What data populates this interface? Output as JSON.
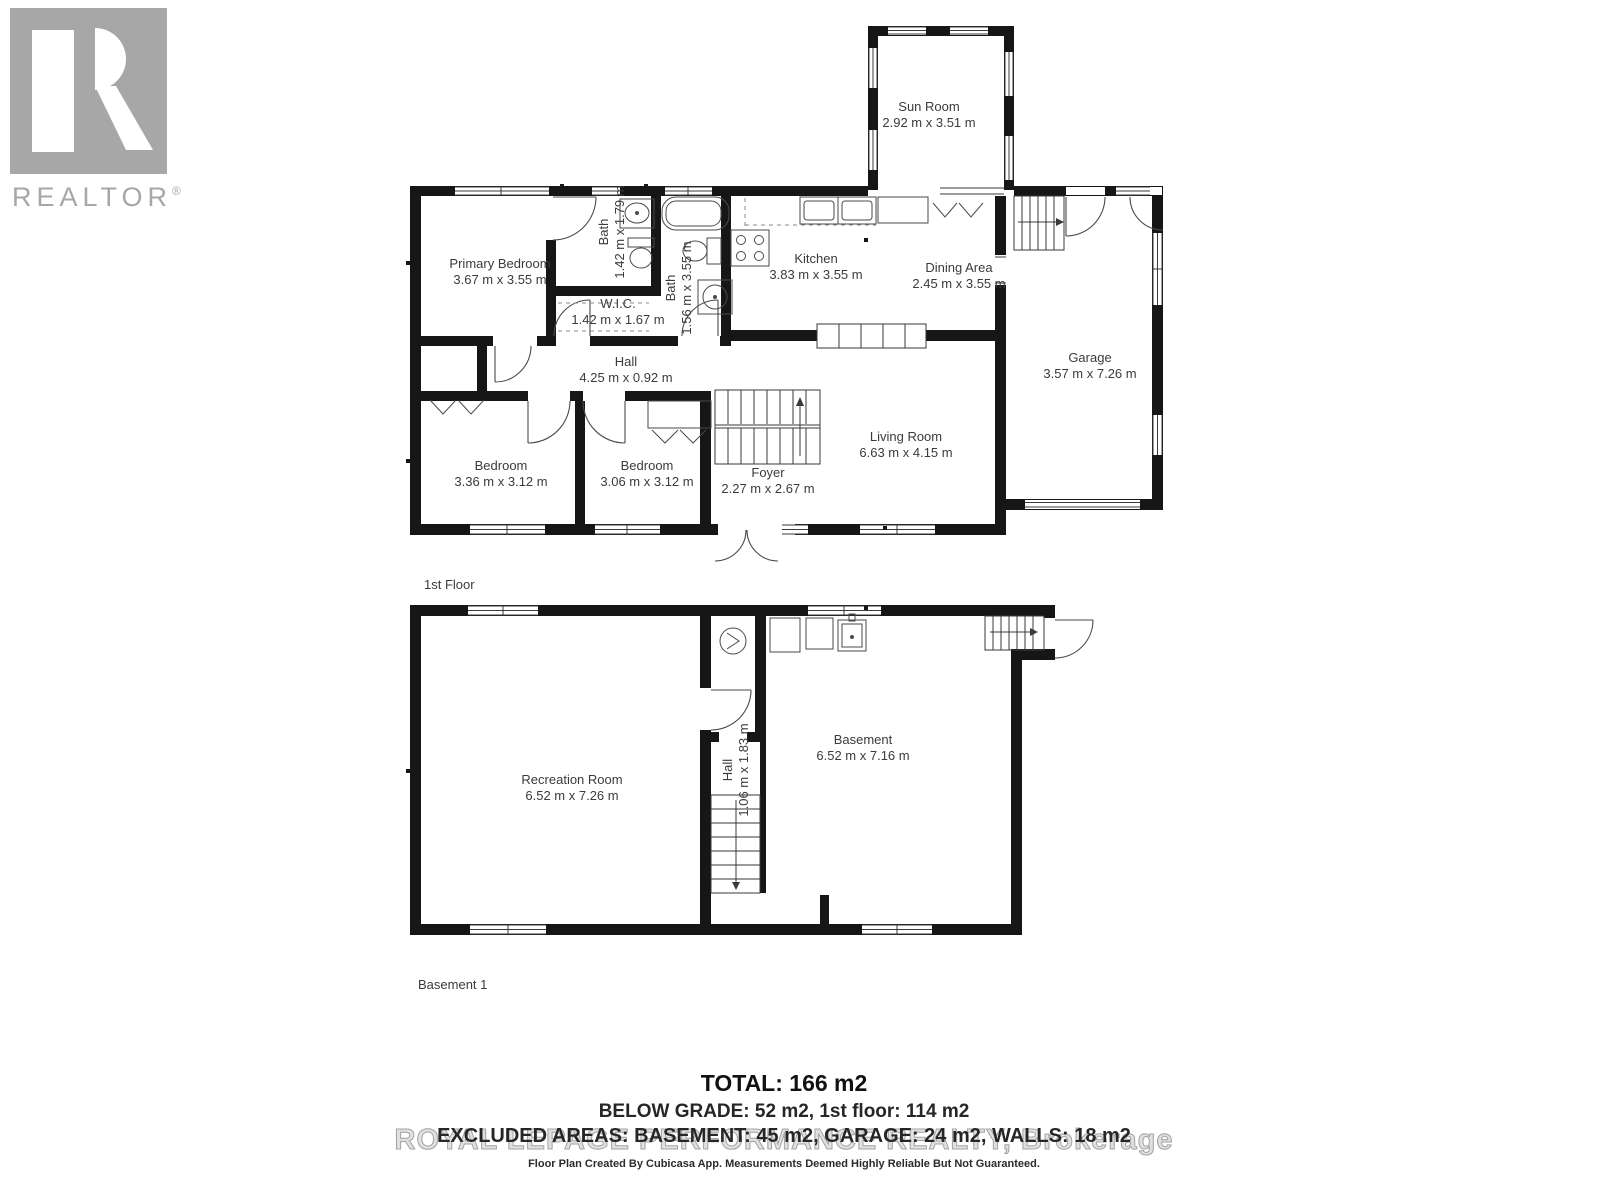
{
  "brand": {
    "logo_letter": "R",
    "logo_text": "REALTOR",
    "registered": "®"
  },
  "floor1": {
    "caption": "1st Floor",
    "rooms": {
      "sun_room": {
        "name": "Sun Room",
        "dims": "2.92 m x 3.51 m"
      },
      "primary_bedroom": {
        "name": "Primary Bedroom",
        "dims": "3.67 m x 3.55 m"
      },
      "bath1": {
        "name": "Bath",
        "dims": "1.42 m x 1.79 m"
      },
      "wic": {
        "name": "W.I.C.",
        "dims": "1.42 m x 1.67 m"
      },
      "bath2": {
        "name": "Bath",
        "dims": "1.56 m x 3.55 m"
      },
      "kitchen": {
        "name": "Kitchen",
        "dims": "3.83 m x 3.55 m"
      },
      "dining": {
        "name": "Dining Area",
        "dims": "2.45 m x 3.55 m"
      },
      "garage": {
        "name": "Garage",
        "dims": "3.57 m x 7.26 m"
      },
      "hall": {
        "name": "Hall",
        "dims": "4.25 m x 0.92 m"
      },
      "bedroom_left": {
        "name": "Bedroom",
        "dims": "3.36 m x 3.12 m"
      },
      "bedroom_mid": {
        "name": "Bedroom",
        "dims": "3.06 m x 3.12 m"
      },
      "foyer": {
        "name": "Foyer",
        "dims": "2.27 m x 2.67 m"
      },
      "living_room": {
        "name": "Living Room",
        "dims": "6.63 m x 4.15 m"
      }
    }
  },
  "basement": {
    "caption": "Basement 1",
    "rooms": {
      "recreation": {
        "name": "Recreation Room",
        "dims": "6.52 m x 7.26 m"
      },
      "hall": {
        "name": "Hall",
        "dims": "1.06 m x 1.83 m"
      },
      "basement": {
        "name": "Basement",
        "dims": "6.52 m x 7.16 m"
      }
    }
  },
  "summary": {
    "total": "TOTAL: 166 m2",
    "grades": "BELOW GRADE: 52 m2, 1st floor: 114 m2",
    "excluded": "EXCLUDED AREAS: BASEMENT: 45 m2, GARAGE: 24 m2, WALLS: 18 m2",
    "watermark": "ROYAL LEPAGE PERFORMANCE REALTY, Brokerage",
    "disclaimer": "Floor Plan Created By Cubicasa App. Measurements Deemed Highly Reliable But Not Guaranteed."
  },
  "colors": {
    "wall": "#161616",
    "logo_gray": "#a7a7a7",
    "label_text": "#3b3b3b",
    "watermark_gray": "#e0e0e0"
  }
}
